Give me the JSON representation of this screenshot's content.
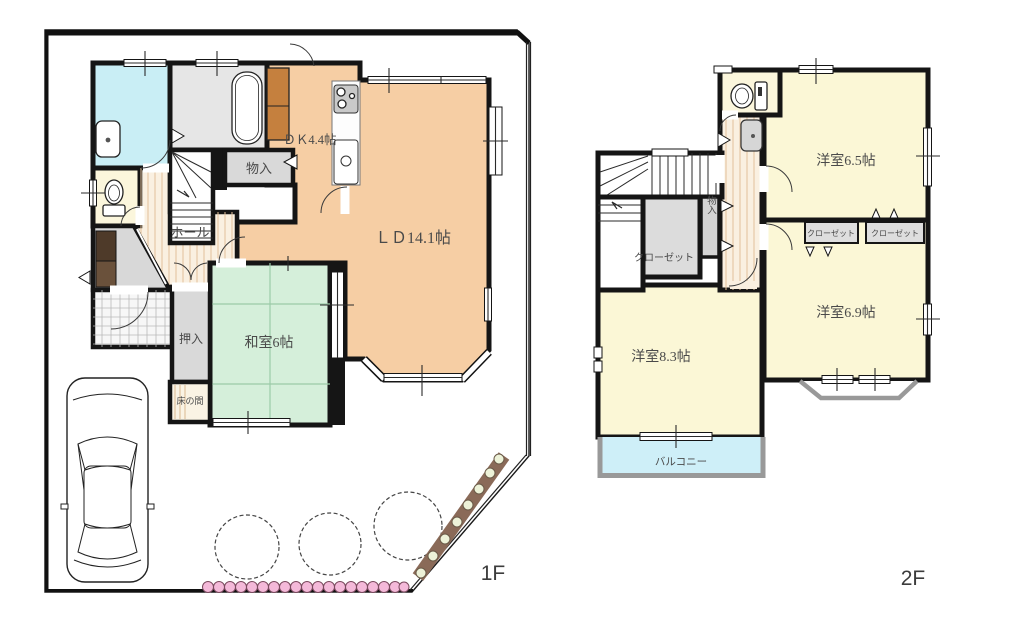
{
  "palette": {
    "wall": "#151515",
    "wood_floor": "#F6CEA4",
    "tatami_green": "#D5EFDA",
    "bath_cyan": "#C9EEF5",
    "balcony_blue": "#CEEFF8",
    "room_cream": "#FBF7D6",
    "closet_gray": "#DCDCDC",
    "hall_stripe_bg": "#FAF0E1",
    "hedge_pink": "#F4B9D9",
    "hedge_brown": "#8A6A58"
  },
  "floor1": {
    "label": "1F",
    "rooms": {
      "dk": "ＤＫ4.4帖",
      "ld": "ＬＤ14.1帖",
      "storage": "物入",
      "hall": "ホール",
      "oshiire": "押入",
      "washitsu": "和室6帖",
      "tokonoma": "床の間"
    }
  },
  "floor2": {
    "label": "2F",
    "rooms": {
      "west65": "洋室6.5帖",
      "west69": "洋室6.9帖",
      "west83": "洋室8.3帖",
      "closet_main": "クローゼット",
      "closet_left": "クローゼット",
      "closet_right": "クローゼット",
      "storage": "物入",
      "balcony": "バルコニー"
    }
  }
}
